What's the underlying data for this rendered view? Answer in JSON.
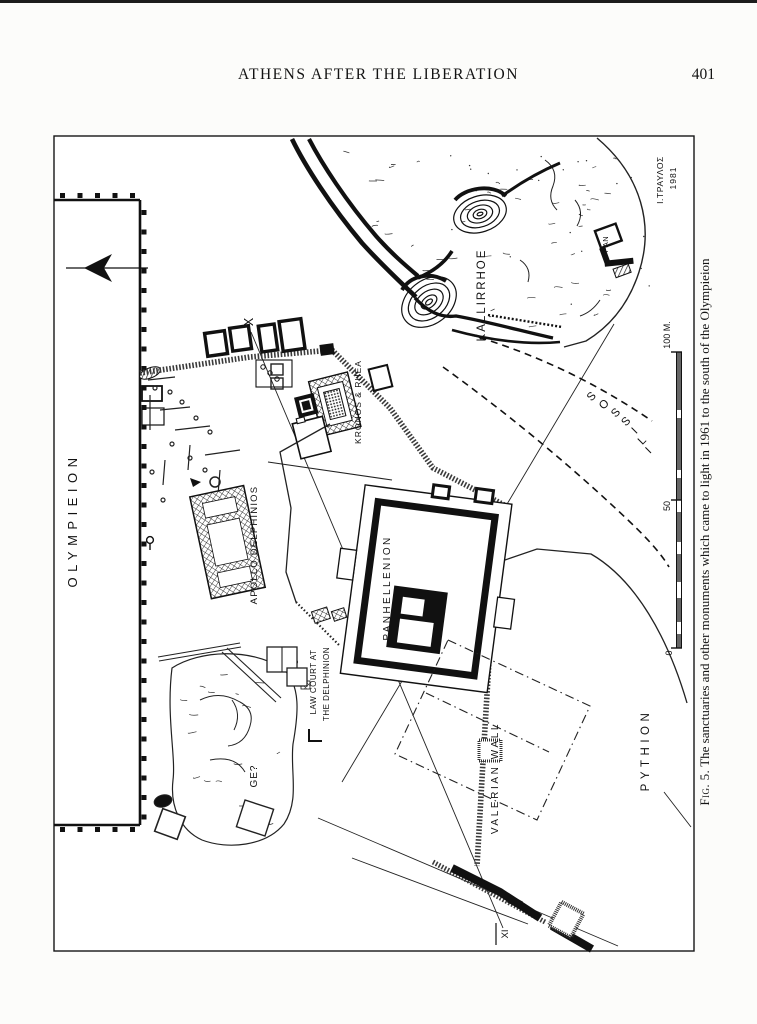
{
  "page": {
    "header_title": "ATHENS AFTER THE LIBERATION",
    "page_number": "401",
    "caption_prefix": "Fig. 5.",
    "caption_text": "The sanctuaries and other monuments which came to light in 1961 to the south of the Olympieion"
  },
  "map": {
    "labels": {
      "olympieion": "OLYMPIEION",
      "kallirrhoe": "KALLIRRHOE",
      "ilissos": "ILISSOS",
      "kronos_rhea": "KRONOS & RHEA",
      "apollo_delphinios": "APOLLO  DELPHINIOS",
      "panhellenion": "PANHELLENION",
      "law_court_line1": "LAW COURT AT",
      "law_court_line2": "THE DELPHINION",
      "ge": "GE?",
      "valerian_wall": "VALERIAN  WALL",
      "pythion": "PYTHION",
      "pan": "PAN",
      "point_x": "X",
      "point_xi": "XI",
      "signature": "Ι.ΤΡΑΥΛΟΣ",
      "signature_year": "1981"
    },
    "scale": {
      "top": "100 M.",
      "mid": "50",
      "bottom": "0"
    },
    "ink": "#111111"
  }
}
